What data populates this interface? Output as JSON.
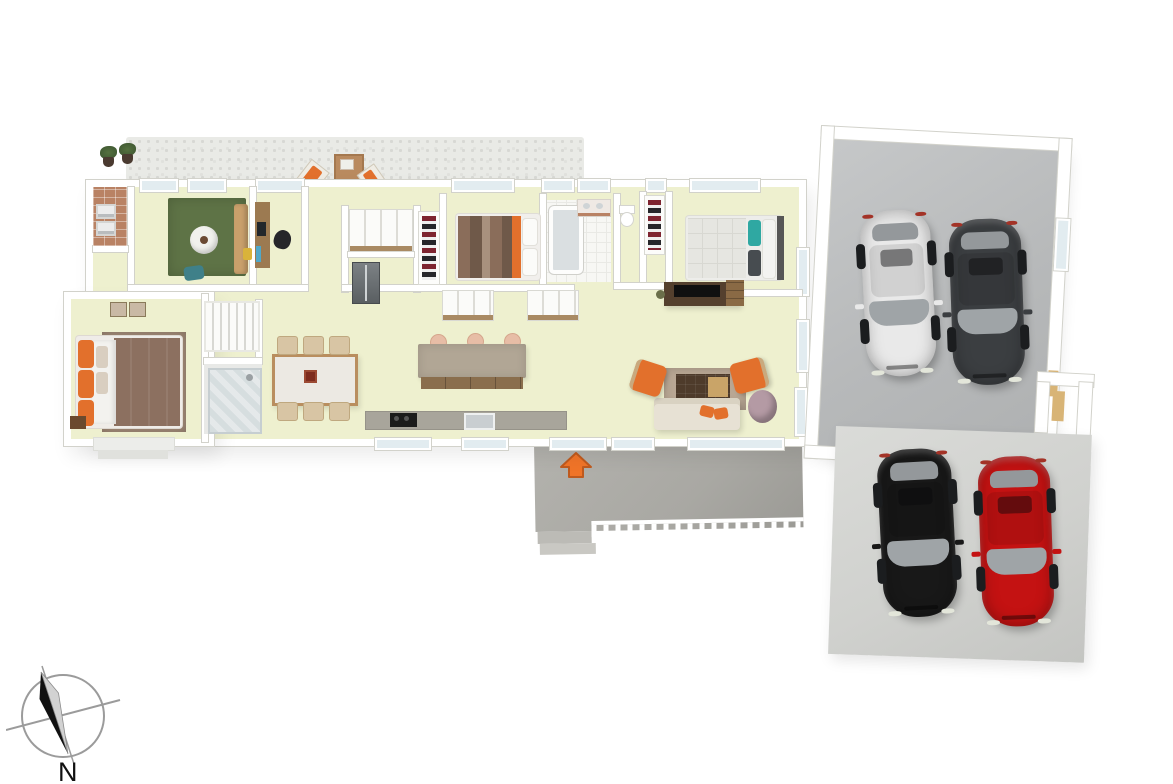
{
  "scene": {
    "description": "3D isometric render of a single-storey house floor plan with front patio, rear deck, double garage and driveway parking",
    "visible_text": [
      "N"
    ]
  },
  "compass": {
    "label": "N"
  },
  "entrance": {
    "arrow_direction": "up"
  },
  "colors": {
    "floor": "#eef0cf",
    "wall": "#ffffff",
    "wall_edge": "#d2d2cb",
    "glass": "#e2ecf0",
    "patio": "#e9eae6",
    "deck": "#a9a8a3",
    "garage_floor": "#b7b9ba",
    "driveway": "#d0d1ce",
    "accent_orange": "#e2702c",
    "arrow_orange": "#f07428",
    "rug_green": "#5e7346",
    "rug_brown": "#a18a77",
    "rug_living": "#b9a794",
    "sofa_cream": "#e7e1d4",
    "wood_brown": "#8a6e4d",
    "brick": "#b98264"
  },
  "house": {
    "rooms": [
      "laundry",
      "lounge",
      "study",
      "pantry",
      "bedroom-2",
      "bathroom",
      "wc",
      "bedroom-3",
      "master-bedroom",
      "ensuite-shower",
      "stairs",
      "open-plan-kitchen-dining-living",
      "front-patio",
      "rear-deck"
    ]
  },
  "garage": {
    "cars": [
      {
        "name": "white-car",
        "color": "#e9e9e9"
      },
      {
        "name": "dark-gray-car",
        "color": "#3b3e41"
      }
    ]
  },
  "driveway": {
    "cars": [
      {
        "name": "black-car",
        "color": "#181818"
      },
      {
        "name": "red-car",
        "color": "#c41212"
      }
    ]
  }
}
